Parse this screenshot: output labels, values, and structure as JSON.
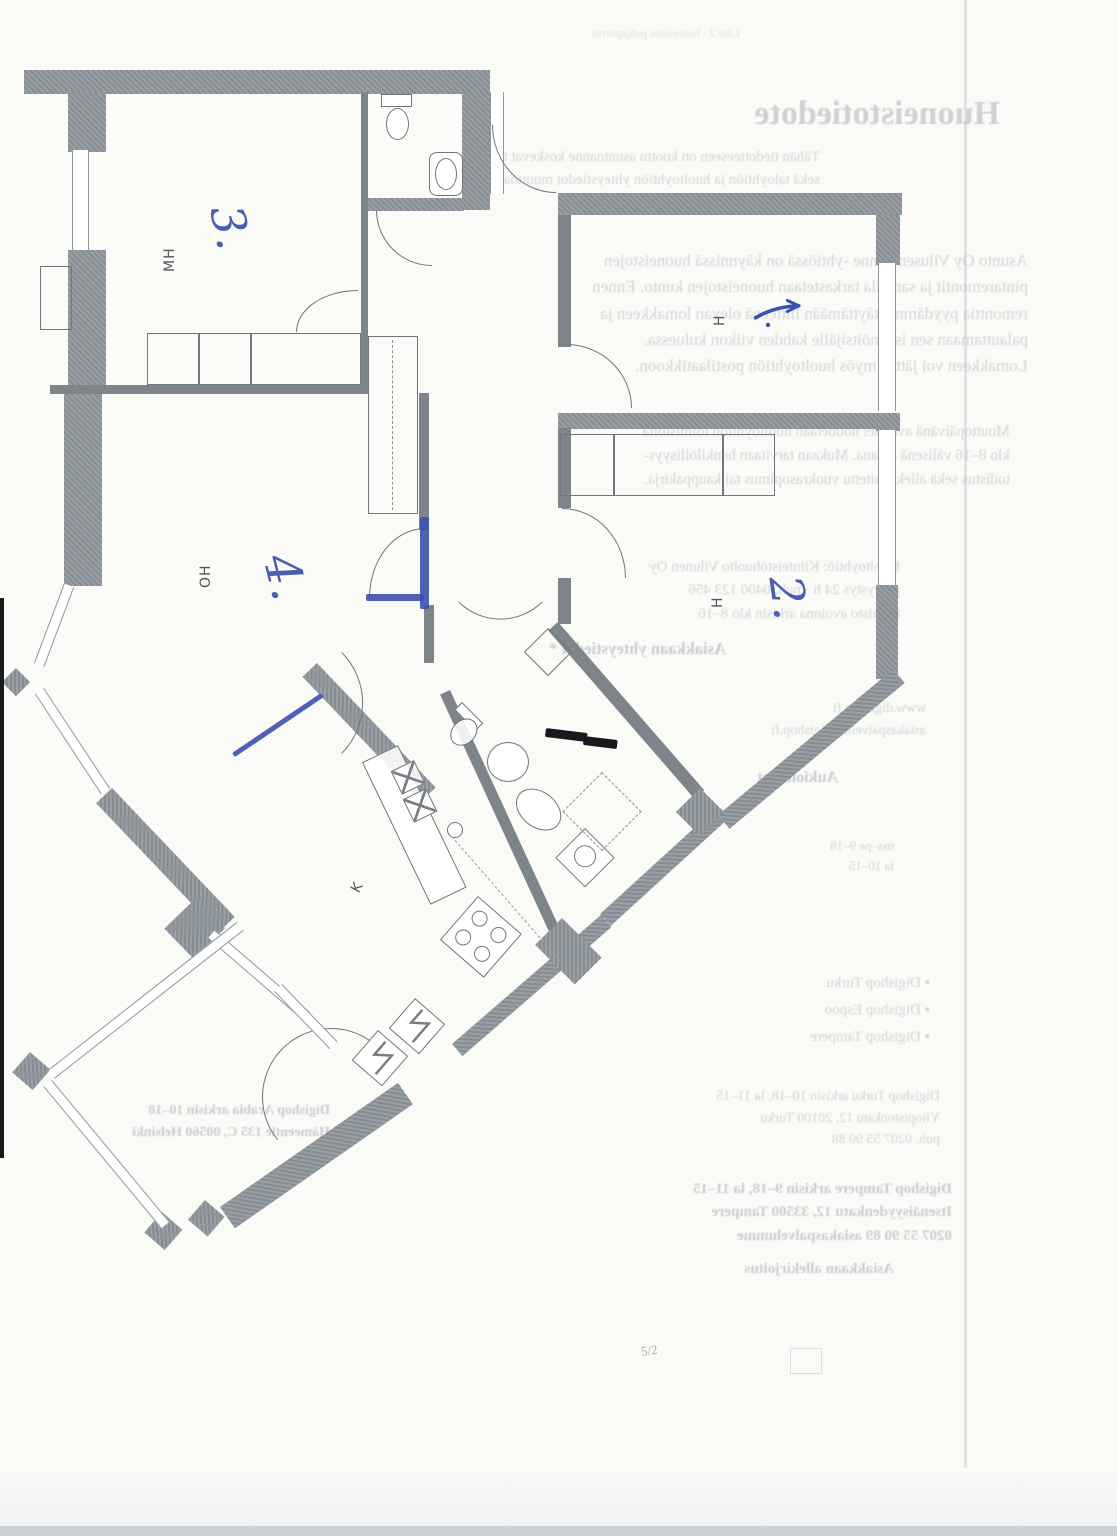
{
  "page": {
    "width": 1117,
    "height": 1536,
    "kind": "scanned floor plan with handwritten pen marks"
  },
  "colors": {
    "wall_gray": "#8f969b",
    "pen_blue": "#3b51ae",
    "marker_black": "#17191c",
    "paper": "#fafaf6"
  },
  "floor_plan": {
    "room_labels": {
      "mh": "MH",
      "oh": "OH",
      "k": "K",
      "h1": "H",
      "h2": "H"
    },
    "pen_marks": {
      "one": "1.",
      "two": "2.",
      "three": "3.",
      "four": "4."
    }
  },
  "pencil_note": "5/2",
  "bleed": {
    "title": "Huoneistotiedote",
    "topline": "Liite 2 · huoneiston pohjapiirros",
    "p1": [
      "Tähän tiedotteeseen on koottu asuntoanne koskevat tiedot",
      "sekä taloyhtiön ja huoltoyhtiön yhteystiedot muuttoa varten."
    ],
    "p2": [
      "Asunto Oy Vilusen Rinne -yhtiössä on käynnissä huoneistojen",
      "pintaremontit ja samalla tarkastetaan huoneistojen kunto. Ennen",
      "remonttia pyydämme täyttämään liitteenä olevan lomakkeen ja",
      "palauttamaan sen isännöitsijälle kahden viikon kuluessa.",
      "Lomakkeen voi jättää myös huoltoyhtiön postilaatikkoon."
    ],
    "p3": [
      "Muuttopäivänä avaimet noudetaan huoltoyhtiön toimistolta",
      "klo 8–16 välisenä aikana. Mukaan tarvitaan henkilöllisyys-",
      "todistus sekä allekirjoitettu vuokrasopimus tai kauppakirja."
    ],
    "p4": [
      "Huoltoyhtiö: Kiinteistöhuolto Vilunen Oy",
      "päivystys 24 h · puh. 0400 123 456",
      "toimisto avoinna arkisin klo 8–16"
    ],
    "bold1": "Asiakkaan yhteystiedot *",
    "p5": [
      "www.digishop.fi",
      "asiakaspalvelu@digishop.fi"
    ],
    "bold2": "Aukioloajat",
    "p6": [
      "ma–pe 9–18",
      "la 10–15"
    ],
    "bullets": [
      "▪  Digishop Turku",
      "▪  Digishop Espoo",
      "▪  Digishop Tampere"
    ],
    "p7": [
      "Digishop Turku arkisin 10–18, la 11–15",
      "Yliopistonkatu 12, 20100 Turku",
      "puh. 0207 55 90 88"
    ],
    "bold3": [
      "Digishop Tampere arkisin 9–18, la 11–15",
      "Itsenäisyydenkatu 12, 33500 Tampere",
      "0207 55 90 89 asiakaspalvelumme"
    ],
    "bold4": "Asiakkaan allekirjoitus",
    "left1": [
      "Digishop Arabia arkisin 10–18",
      "Hämeentie 135 C, 00560 Helsinki"
    ],
    "bottom": "www.digishop.fi · asiakaspalvelu"
  }
}
